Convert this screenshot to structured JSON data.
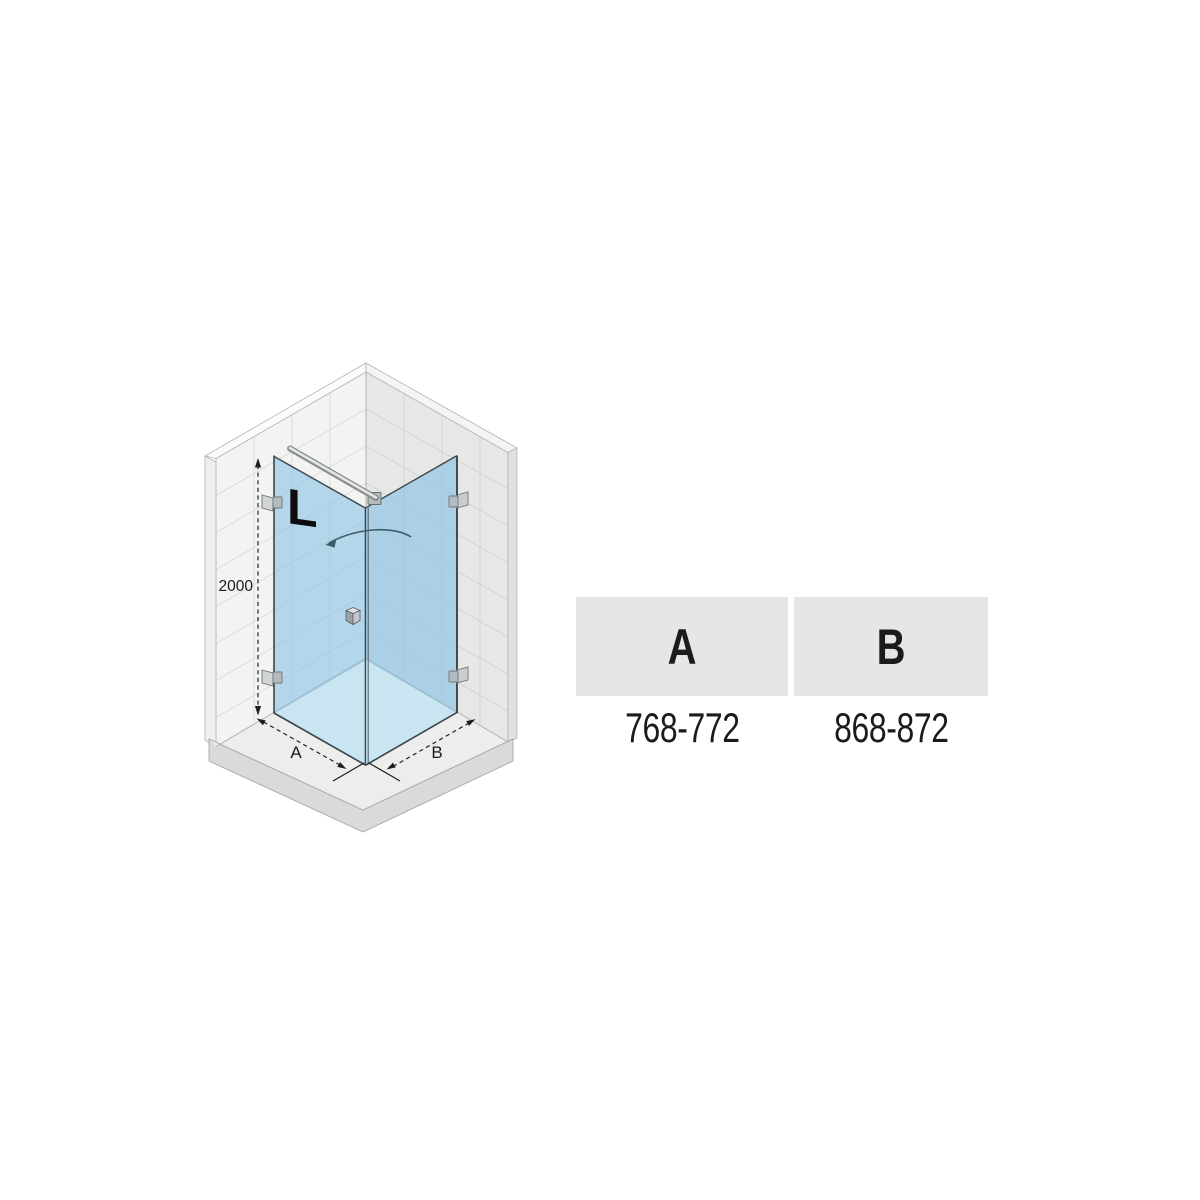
{
  "diagram": {
    "logo_letter": "L",
    "height_dimension_label": "2000",
    "width_dimension_a_label": "A",
    "width_dimension_b_label": "B"
  },
  "spec_table": {
    "columns": [
      {
        "header": "A",
        "value": "768-772"
      },
      {
        "header": "B",
        "value": "868-872"
      }
    ]
  },
  "colors": {
    "glass_blue": "#b3d6ea",
    "shower_floor_blue": "#c9e5f1",
    "table_header_bg": "#e5e6e8",
    "wall_tile_left": "#f3f3f1",
    "wall_tile_right": "#e7e7e5"
  }
}
